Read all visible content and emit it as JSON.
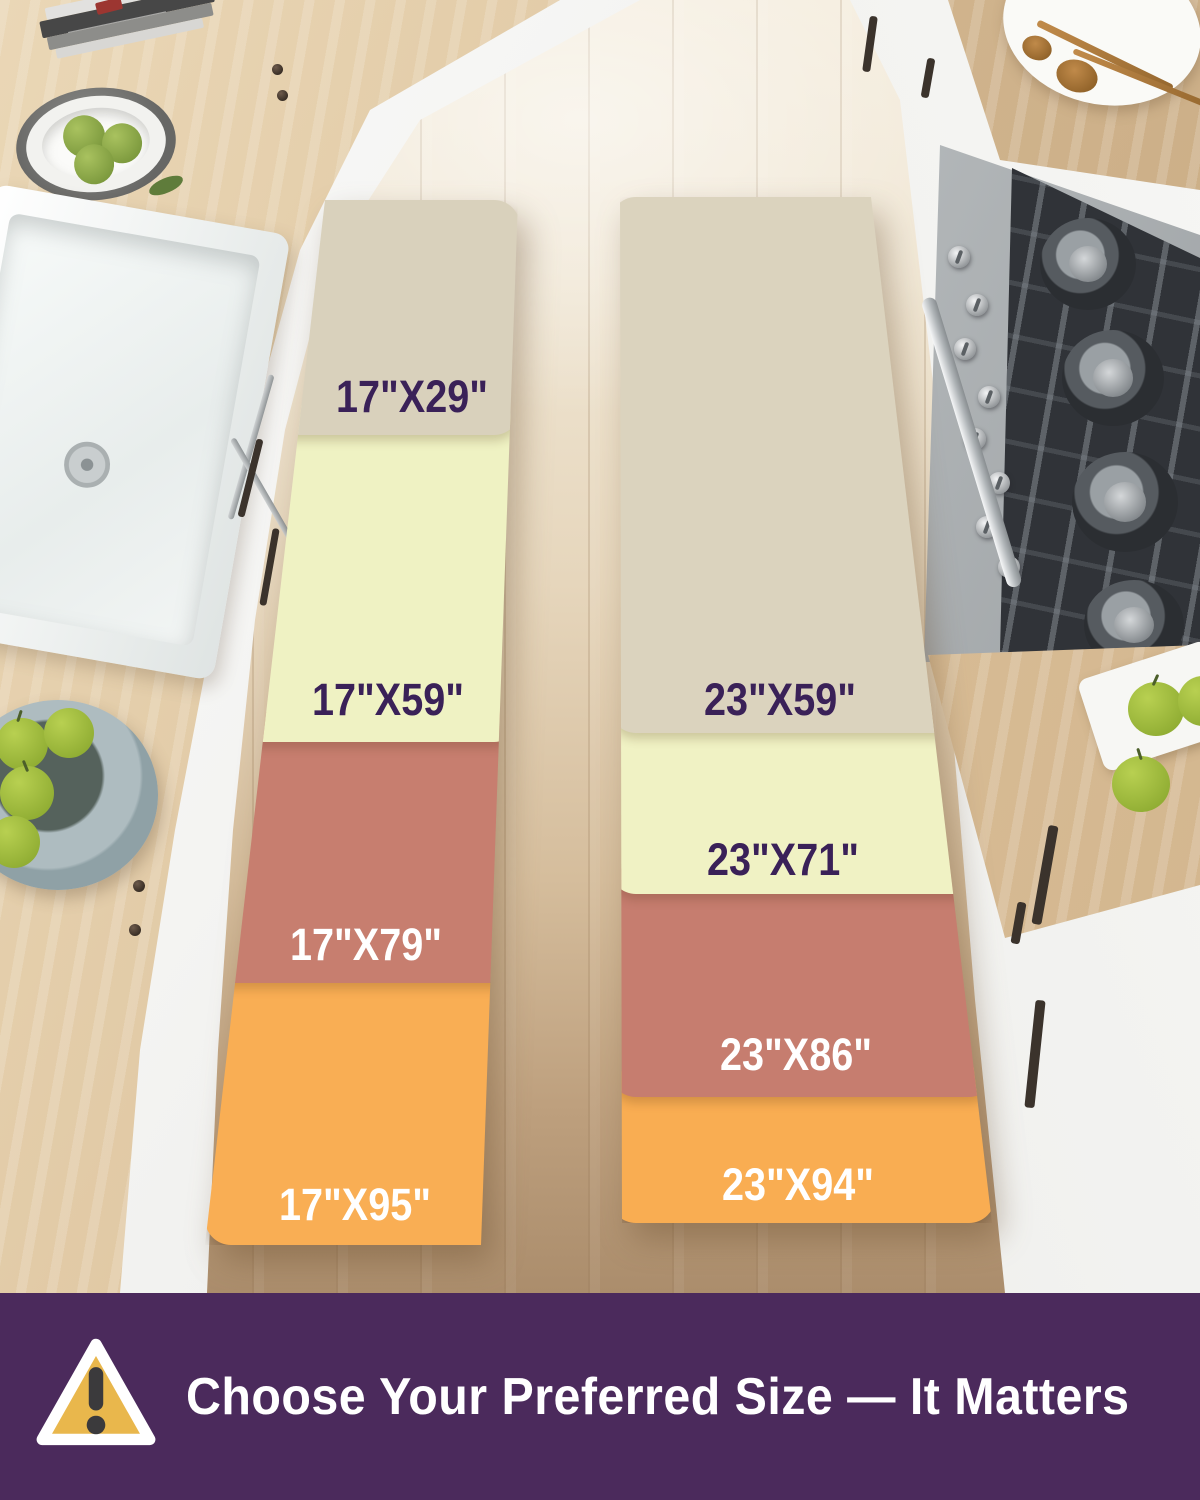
{
  "mats": {
    "left": {
      "width_group": "17\"",
      "segments": [
        {
          "size": "17\"X29\"",
          "color": "#d9d1bc",
          "text_color": "#3a2158"
        },
        {
          "size": "17\"X59\"",
          "color": "#eff2c3",
          "text_color": "#3a2158"
        },
        {
          "size": "17\"X79\"",
          "color": "#c77e6f",
          "text_color": "#ffffff"
        },
        {
          "size": "17\"X95\"",
          "color": "#f9ae54",
          "text_color": "#ffffff"
        }
      ]
    },
    "right": {
      "width_group": "23\"",
      "segments": [
        {
          "size": "23\"X59\"",
          "color": "#dbd3be",
          "text_color": "#3a2158"
        },
        {
          "size": "23\"X71\"",
          "color": "#f0f2c4",
          "text_color": "#3a2158"
        },
        {
          "size": "23\"X86\"",
          "color": "#c67d6f",
          "text_color": "#ffffff"
        },
        {
          "size": "23\"X94\"",
          "color": "#f9ad52",
          "text_color": "#ffffff"
        }
      ]
    }
  },
  "banner": {
    "text": "Choose Your Preferred Size — It Matters",
    "background": "#4b2a5c",
    "text_color": "#ffffff",
    "icon": "warning-triangle-icon",
    "icon_fill": "#e9b74c",
    "icon_stroke": "#ffffff",
    "icon_mark_color": "#3b3a3c"
  },
  "palette": {
    "floor_top": "#f4ecdc",
    "floor_bottom": "#ab8d6c",
    "counter_wood": "#dcc29c",
    "cabinet_white": "#f4f4f2",
    "apple_green": "#a6c041",
    "range_steel": "#b9bdbf",
    "range_grate": "#303338"
  }
}
